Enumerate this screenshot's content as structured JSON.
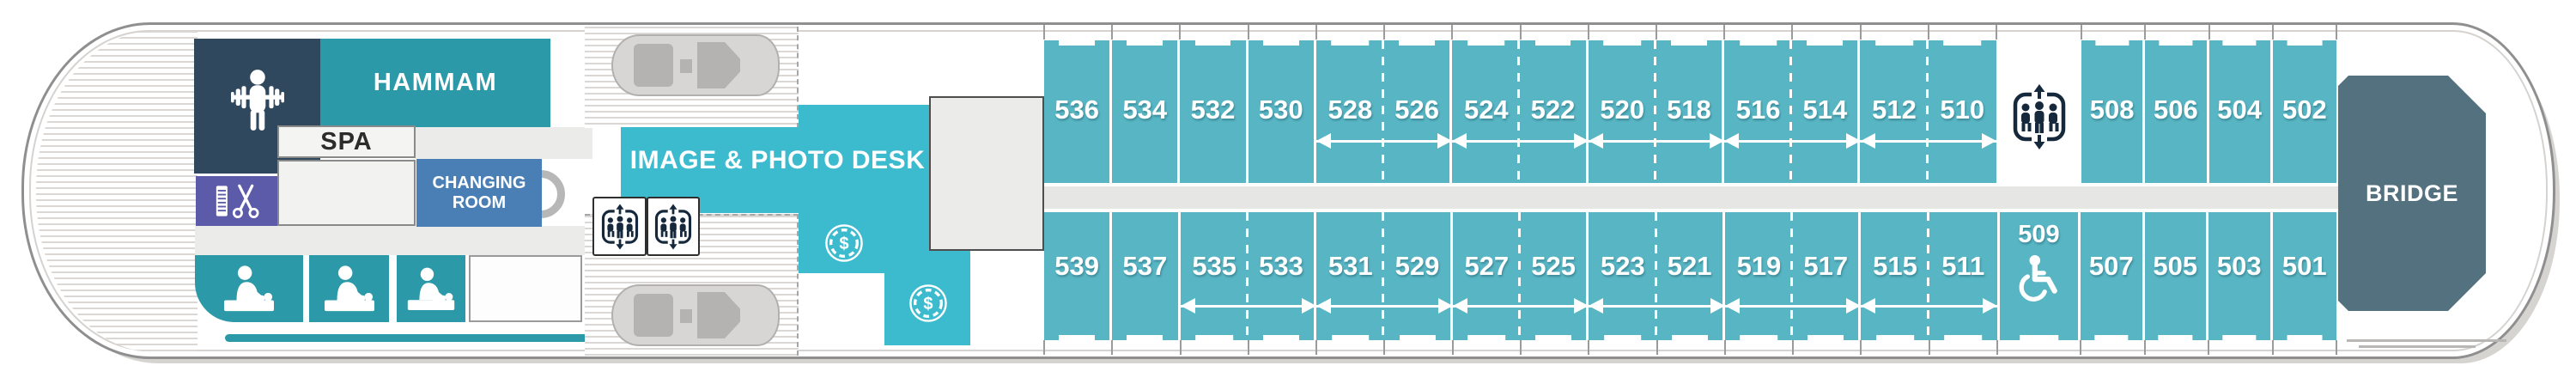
{
  "ship": {
    "areas": {
      "hammam": "HAMMAM",
      "spa": "SPA",
      "changing_room": "CHANGING ROOM",
      "image_photo_desk": "IMAGE & PHOTO DESK",
      "bridge": "BRIDGE"
    },
    "icons": {
      "fitness": "fitness-icon",
      "hair_salon": "salon-icon",
      "massage": "massage-icon",
      "elevator": "elevator-icon",
      "paid_service": "currency-icon",
      "wheelchair_accessible": "wheelchair-icon"
    },
    "cabins": {
      "upper_row": {
        "main": [
          "536",
          "534",
          "532",
          "530",
          "528",
          "526",
          "524",
          "522",
          "520",
          "518",
          "516",
          "514",
          "512",
          "510"
        ],
        "main_dividers": [
          "solid",
          "solid",
          "solid",
          "solid",
          "dashed",
          "solid",
          "dashed",
          "solid",
          "dashed",
          "solid",
          "dashed",
          "solid",
          "dashed"
        ],
        "fwd": [
          "508",
          "506",
          "504",
          "502"
        ],
        "fwd_dividers": [
          "solid",
          "solid",
          "solid"
        ],
        "connecting_span": {
          "from": "528",
          "to": "510"
        }
      },
      "lower_row": {
        "main": [
          "539",
          "537",
          "535",
          "533",
          "531",
          "529",
          "527",
          "525",
          "523",
          "521",
          "519",
          "517",
          "515",
          "511"
        ],
        "main_dividers": [
          "solid",
          "solid",
          "dashed",
          "solid",
          "dashed",
          "solid",
          "dashed",
          "solid",
          "dashed",
          "solid",
          "dashed",
          "solid",
          "dashed"
        ],
        "accessible": "509",
        "fwd": [
          "507",
          "505",
          "503",
          "501"
        ],
        "fwd_dividers": [
          "solid",
          "solid",
          "solid"
        ],
        "connecting_span": {
          "from": "535",
          "to": "511"
        }
      }
    },
    "colors": {
      "cabin_teal": "#58b5c3",
      "facility_teal": "#2d98a5",
      "photo_desk_teal": "#3dbbce",
      "fitness_navy": "#30485e",
      "salon_purple": "#5c5baa",
      "changing_blue": "#4a7fb6",
      "bridge_slate": "#54717f"
    }
  }
}
